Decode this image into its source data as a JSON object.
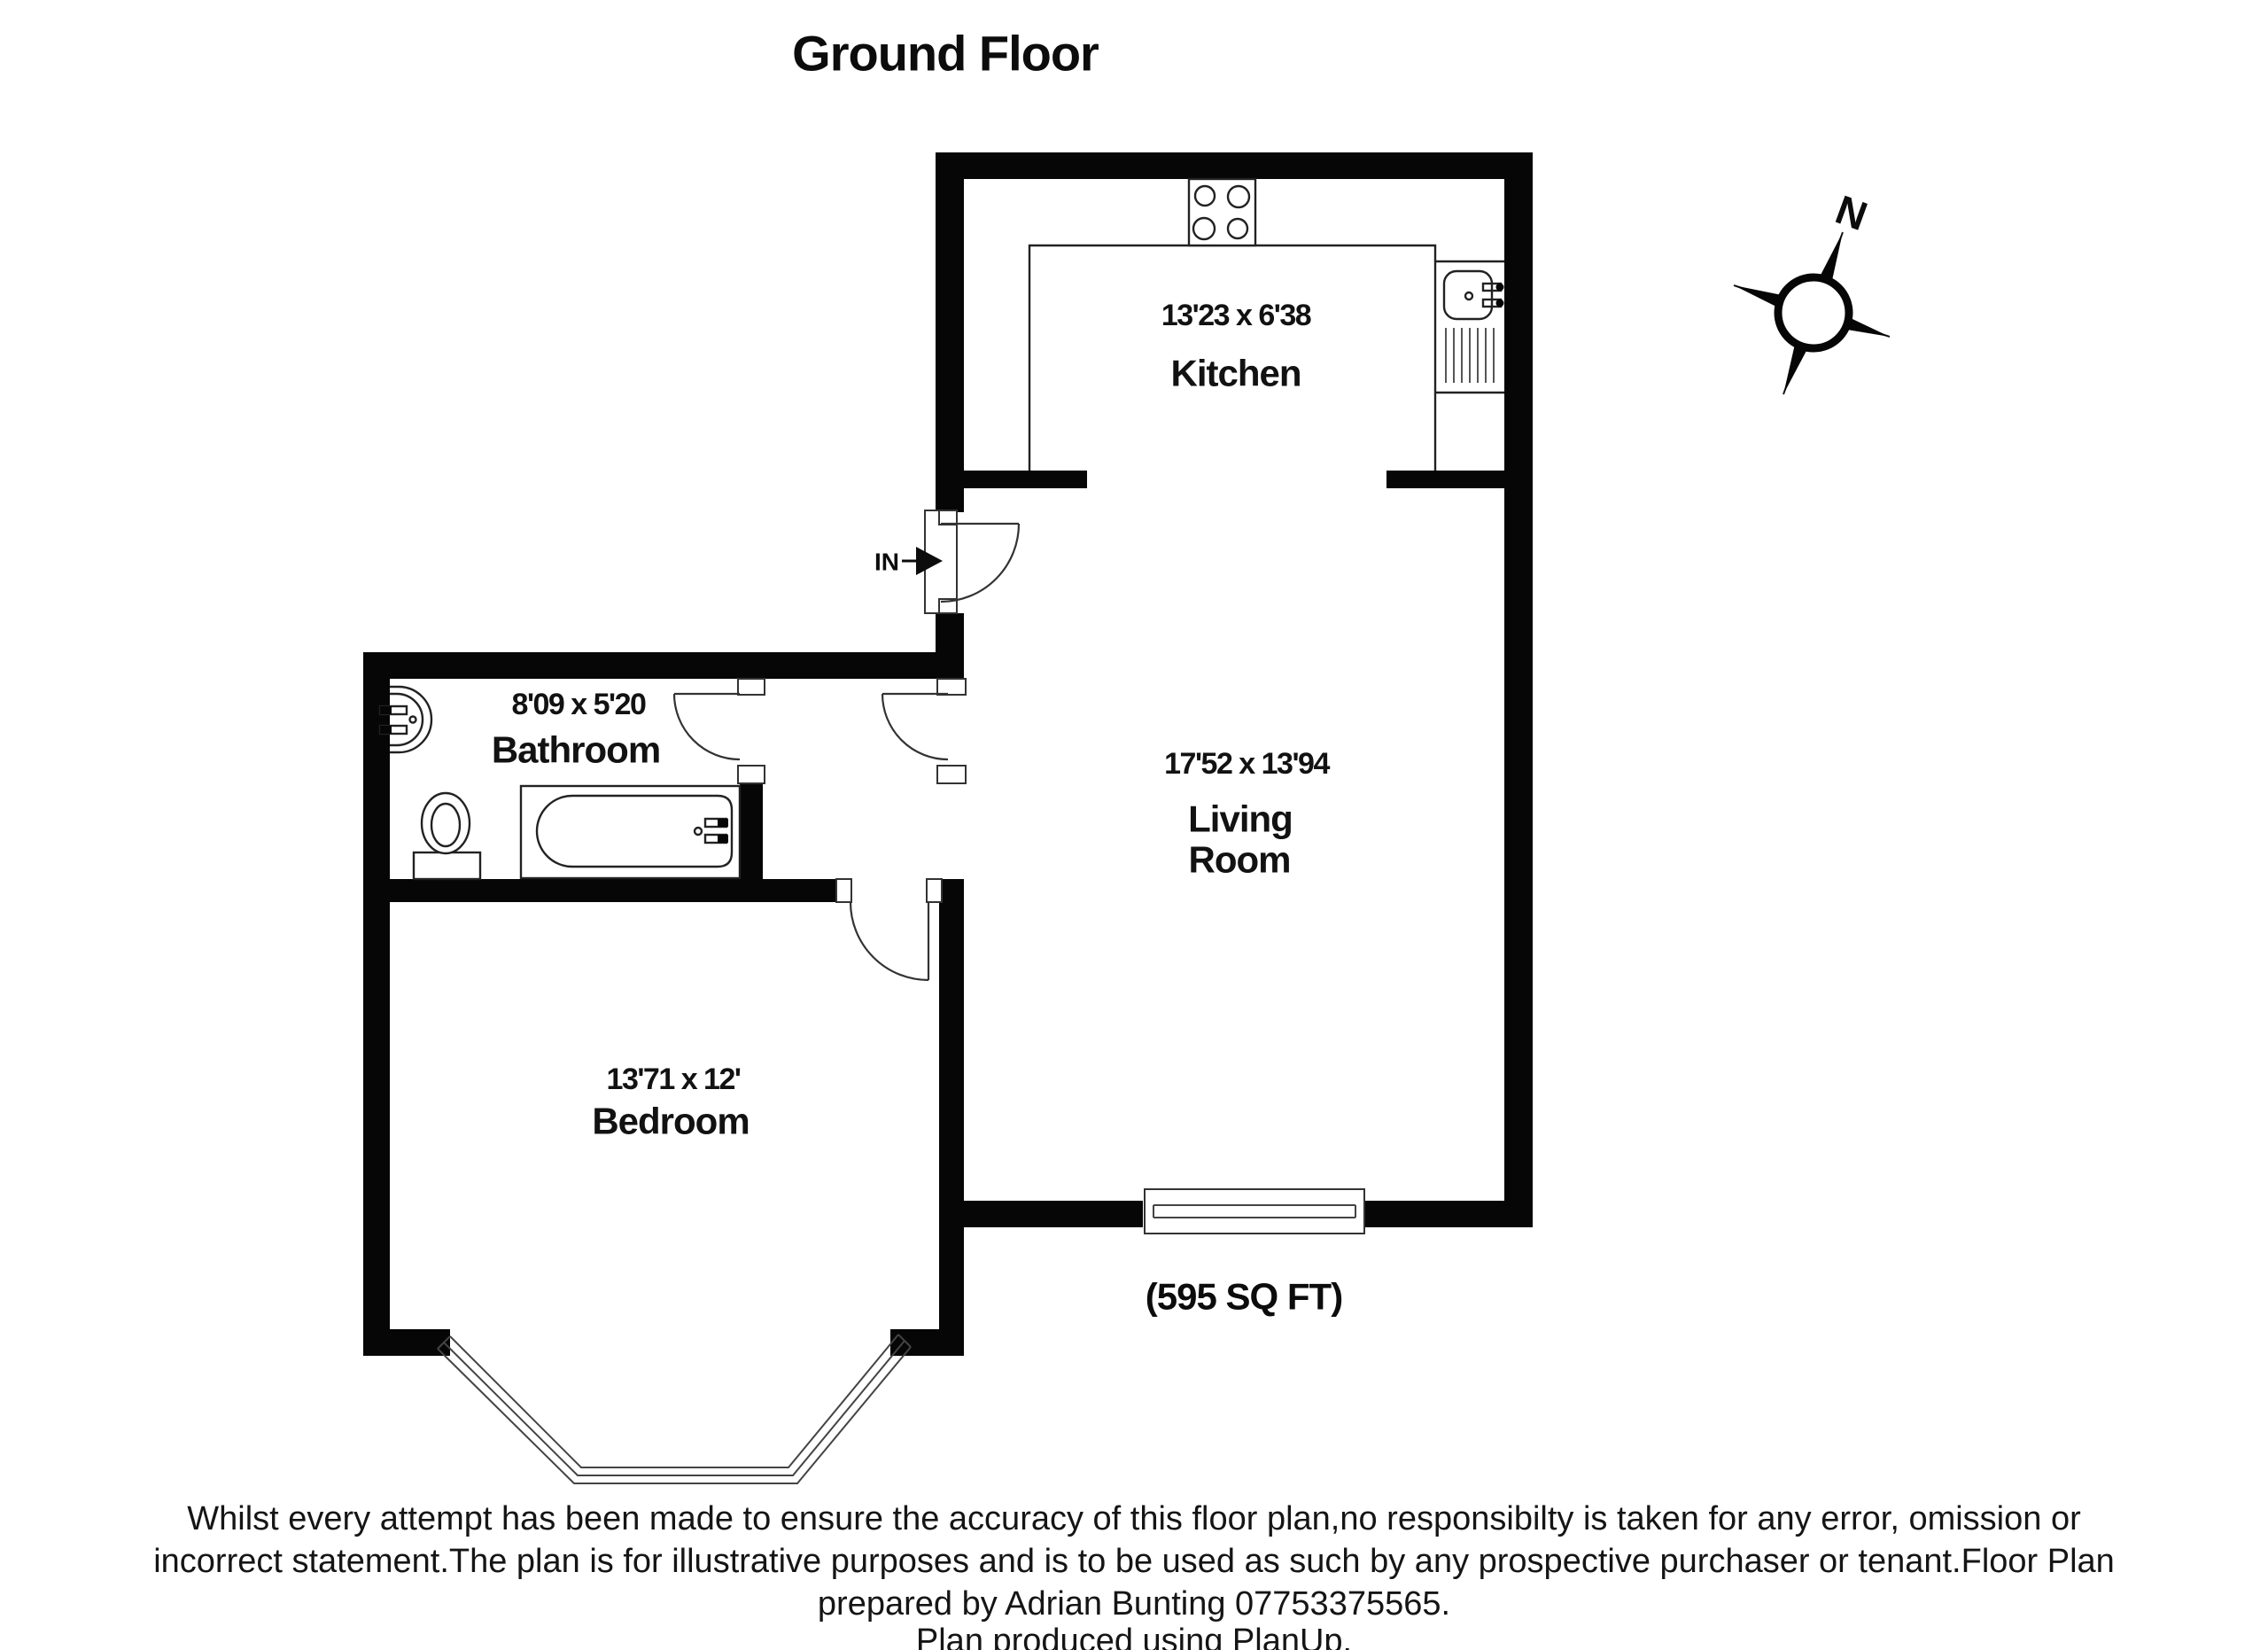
{
  "title": "Ground Floor",
  "compass": {
    "north_label": "N"
  },
  "entrance": {
    "label": "IN"
  },
  "rooms": {
    "kitchen": {
      "dims": "13'23 x 6'38",
      "name": "Kitchen"
    },
    "living": {
      "dims": "17'52 x 13'94",
      "name_line1": "Living",
      "name_line2": "Room"
    },
    "bathroom": {
      "dims": "8'09 x 5'20",
      "name": "Bathroom"
    },
    "bedroom": {
      "dims": "13'71 x 12'",
      "name": "Bedroom"
    }
  },
  "area": {
    "label": "(595 SQ FT)"
  },
  "footer": {
    "line1": "Whilst every attempt has been made to ensure the accuracy of this floor plan,no responsibilty is taken for any error, omission or",
    "line2": "incorrect statement.The plan is for illustrative purposes and is to be used as such by any prospective purchaser or tenant.Floor Plan",
    "line3": "prepared by Adrian Bunting 07753375565.",
    "line4": "Plan produced using PlanUp."
  }
}
